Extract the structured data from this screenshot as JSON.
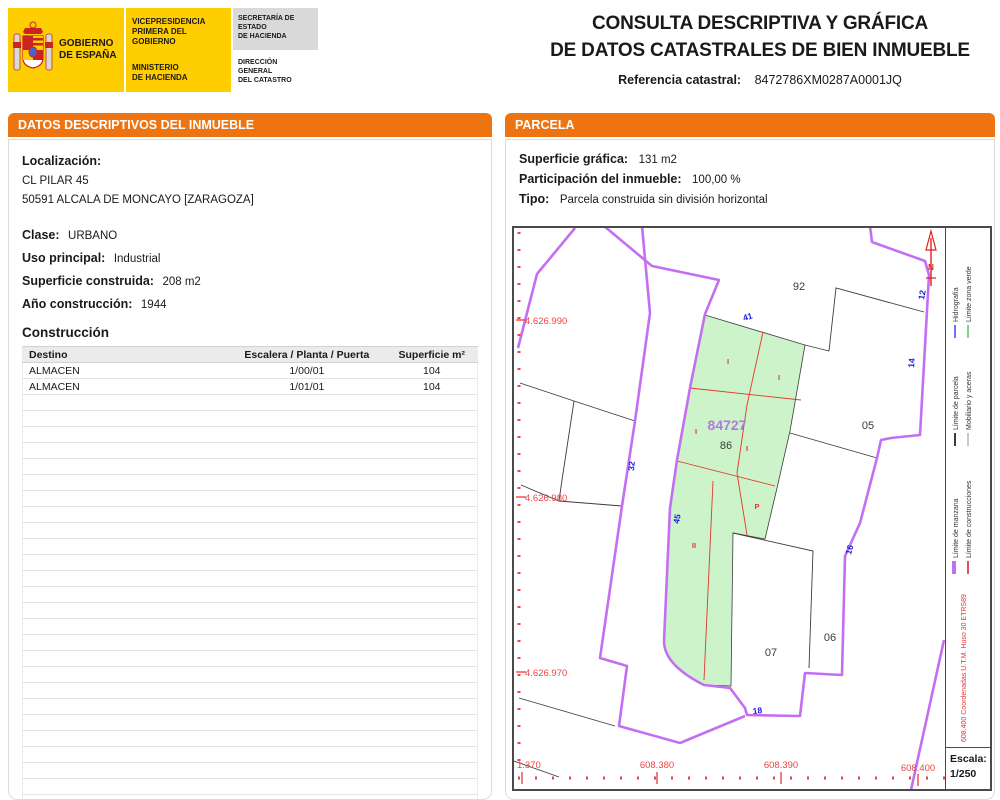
{
  "header": {
    "logo": {
      "gobierno_line1": "GOBIERNO",
      "gobierno_line2": "DE ESPAÑA",
      "vice_line1": "VICEPRESIDENCIA",
      "vice_line2": "PRIMERA DEL GOBIERNO",
      "min_line1": "MINISTERIO",
      "min_line2": "DE HACIENDA",
      "sec_line1": "SECRETARÍA DE ESTADO",
      "sec_line2": "DE HACIENDA",
      "dir_line1": "DIRECCIÓN GENERAL",
      "dir_line2": "DEL CATASTRO"
    },
    "title_line1": "CONSULTA DESCRIPTIVA Y GRÁFICA",
    "title_line2": "DE DATOS CATASTRALES DE BIEN INMUEBLE",
    "ref_label": "Referencia catastral:",
    "ref_value": "8472786XM0287A0001JQ"
  },
  "left_panel": {
    "header": "DATOS DESCRIPTIVOS DEL INMUEBLE",
    "localizacion_label": "Localización:",
    "address_line1": "CL PILAR 45",
    "address_line2": "50591 ALCALA DE MONCAYO [ZARAGOZA]",
    "clase_label": "Clase:",
    "clase_value": "URBANO",
    "uso_label": "Uso principal:",
    "uso_value": "Industrial",
    "superficie_label": "Superficie construida:",
    "superficie_value": "208 m2",
    "anio_label": "Año construcción:",
    "anio_value": "1944",
    "construccion_title": "Construcción",
    "table": {
      "headers": [
        "Destino",
        "Escalera / Planta / Puerta",
        "Superficie m²"
      ],
      "rows": [
        [
          "ALMACEN",
          "1/00/01",
          "104"
        ],
        [
          "ALMACEN",
          "1/01/01",
          "104"
        ]
      ],
      "empty_row_count": 26
    }
  },
  "right_panel": {
    "header": "PARCELA",
    "sup_grafica_label": "Superficie gráfica:",
    "sup_grafica_value": "131 m2",
    "participacion_label": "Participación del inmueble:",
    "participacion_value": "100,00 %",
    "tipo_label": "Tipo:",
    "tipo_value": "Parcela construida sin división horizontal",
    "map": {
      "manzana_label": "84727",
      "parcel_92": "92",
      "parcel_05": "05",
      "parcel_86": "86",
      "parcel_07": "07",
      "parcel_06": "06",
      "num_41": "41",
      "num_32": "32",
      "num_45": "45",
      "num_12": "12",
      "num_14": "14",
      "num_16": "16",
      "num_18": "18",
      "c_label_0": "I",
      "c_label_1": "I",
      "c_label_2": "I",
      "c_label_3": "I",
      "c_label_4": "P",
      "c_label_5": "II",
      "y_coord_0": "4.626.990",
      "y_coord_1": "4.626.980",
      "y_coord_2": "4.626.970",
      "x_coord_0": "1.370",
      "x_coord_1": "608.380",
      "x_coord_2": "608.390",
      "x_coord_3": "608.400",
      "north_label": "N",
      "colors": {
        "manzana": "#c46ff2",
        "parcela_line": "#3c3c3c",
        "construcciones": "#e0392a",
        "zona_verde_fill": "#cdf3cb",
        "street_number": "#1a1ae0",
        "coordinate": "#ee4444",
        "manzana_text": "#b07ae0"
      }
    },
    "legend": {
      "entries": [
        {
          "label": "Hidrografía",
          "swatch": "background:#7070ff"
        },
        {
          "label": "Límite zona verde",
          "swatch": "background:#7fd87f"
        },
        {
          "label": "Límite de parcela",
          "swatch": "background:#3c3c3c"
        },
        {
          "label": "Mobiliario y aceras",
          "swatch": "background:#c8c8c8"
        },
        {
          "label": "Límite de manzana",
          "swatch": "background:#c46ff2;height:4px"
        },
        {
          "label": "Límite de construcciones",
          "swatch": "background:#e05050"
        }
      ],
      "coord_note": "608.400 Coordenadas U.T.M. Huso 30 ETRS89",
      "escala_label": "Escala:",
      "escala_value": "1/250"
    }
  }
}
